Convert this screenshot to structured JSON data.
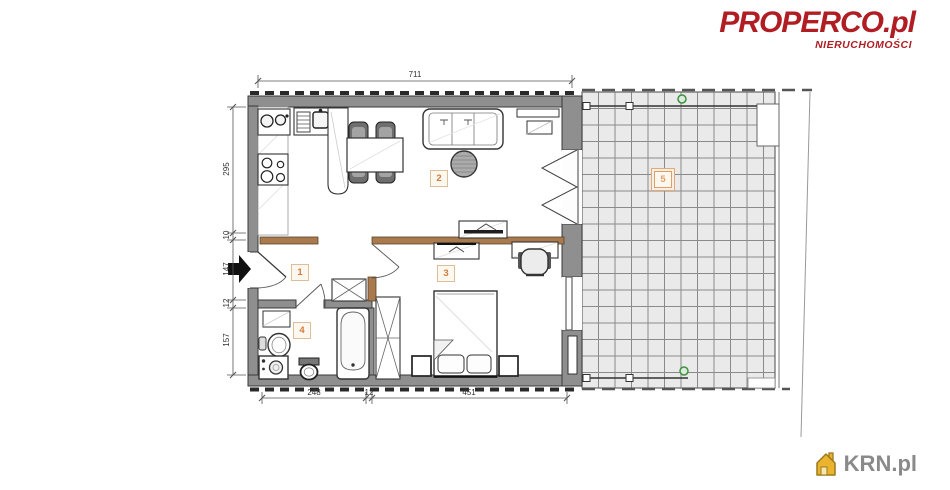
{
  "branding": {
    "logo": {
      "text": "PROPERCO.pl",
      "tagline": "NIERUCHOMOŚCI",
      "color": "#b01e23"
    },
    "watermark": {
      "text": "KRN.pl",
      "color": "#8a8a8a",
      "icon": "house-icon",
      "icon_color": "#ecb32e"
    }
  },
  "floorplan": {
    "room_labels": [
      "1",
      "2",
      "3",
      "4",
      "5"
    ],
    "dimensions": {
      "top": "711",
      "bottom": [
        "248",
        "12",
        "451"
      ],
      "left": [
        "295",
        "10",
        "147",
        "12",
        "157"
      ]
    },
    "colors": {
      "wall": "#8f8f8f",
      "wood_partition": "#a97a4e",
      "room_label": "#d07c3a",
      "balcony_grid": "#8a8a8a",
      "balcony_marker": "#3f8f3f"
    }
  }
}
